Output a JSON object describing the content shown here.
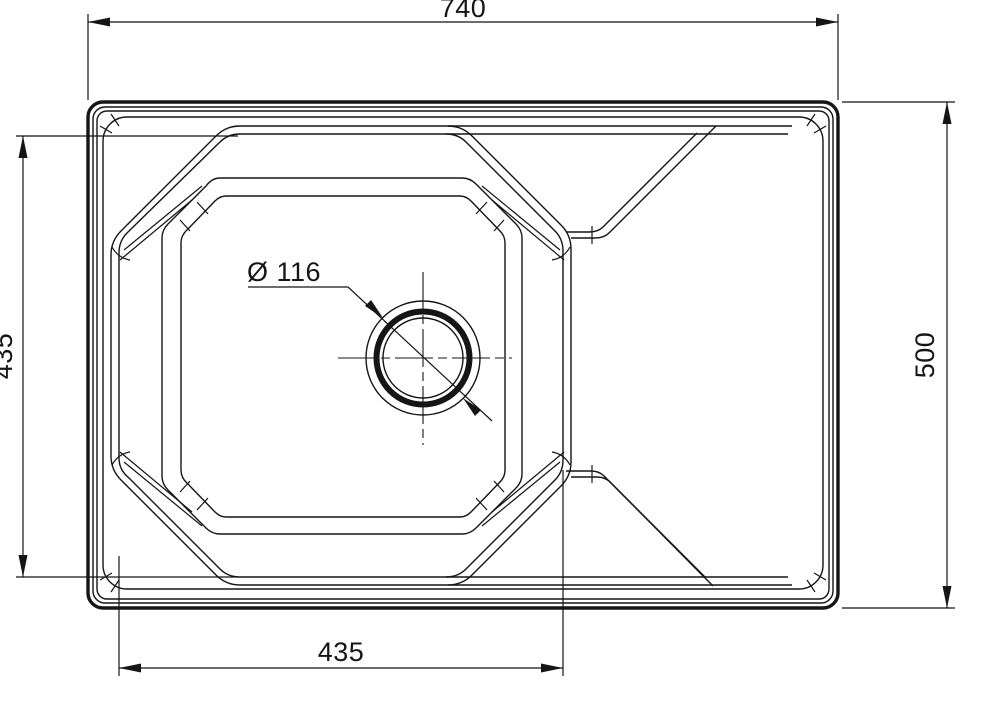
{
  "drawing": {
    "background_color": "#ffffff",
    "line_color": "#151515",
    "view": "sink-top-view",
    "dimensions": {
      "overall_width_label": "740",
      "overall_depth_label": "500",
      "bowl_depth_label": "435",
      "bowl_width_label": "435",
      "drain_diameter_label": "Ø 116"
    }
  }
}
